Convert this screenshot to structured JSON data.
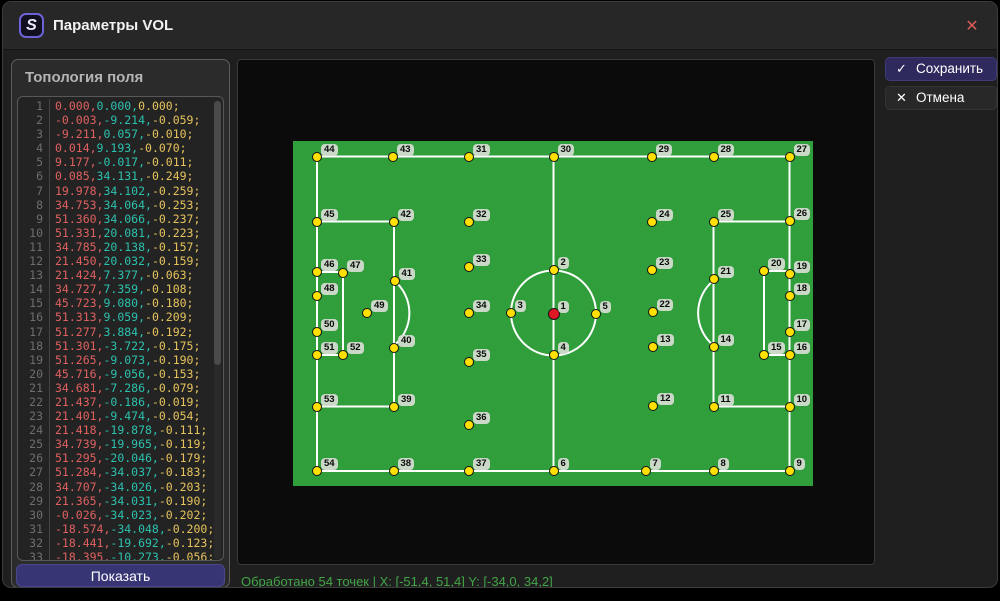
{
  "window": {
    "title": "Параметры VOL",
    "logo_letter": "S",
    "close_glyph": "✕"
  },
  "left_panel": {
    "header": "Топология поля",
    "show_button": "Показать",
    "editor": {
      "lines": [
        {
          "n": 1,
          "x": "0.000",
          "y": "0.000",
          "z": "0.000"
        },
        {
          "n": 2,
          "x": "-0.003",
          "y": "-9.214",
          "z": "-0.059"
        },
        {
          "n": 3,
          "x": "-9.211",
          "y": "0.057",
          "z": "-0.010"
        },
        {
          "n": 4,
          "x": "0.014",
          "y": "9.193",
          "z": "-0.070"
        },
        {
          "n": 5,
          "x": "9.177",
          "y": "-0.017",
          "z": "-0.011"
        },
        {
          "n": 6,
          "x": "0.085",
          "y": "34.131",
          "z": "-0.249"
        },
        {
          "n": 7,
          "x": "19.978",
          "y": "34.102",
          "z": "-0.259"
        },
        {
          "n": 8,
          "x": "34.753",
          "y": "34.064",
          "z": "-0.253"
        },
        {
          "n": 9,
          "x": "51.360",
          "y": "34.066",
          "z": "-0.237"
        },
        {
          "n": 10,
          "x": "51.331",
          "y": "20.081",
          "z": "-0.223"
        },
        {
          "n": 11,
          "x": "34.785",
          "y": "20.138",
          "z": "-0.157"
        },
        {
          "n": 12,
          "x": "21.450",
          "y": "20.032",
          "z": "-0.159"
        },
        {
          "n": 13,
          "x": "21.424",
          "y": "7.377",
          "z": "-0.063"
        },
        {
          "n": 14,
          "x": "34.727",
          "y": "7.359",
          "z": "-0.108"
        },
        {
          "n": 15,
          "x": "45.723",
          "y": "9.080",
          "z": "-0.180"
        },
        {
          "n": 16,
          "x": "51.313",
          "y": "9.059",
          "z": "-0.209"
        },
        {
          "n": 17,
          "x": "51.277",
          "y": "3.884",
          "z": "-0.192"
        },
        {
          "n": 18,
          "x": "51.301",
          "y": "-3.722",
          "z": "-0.175"
        },
        {
          "n": 19,
          "x": "51.265",
          "y": "-9.073",
          "z": "-0.190"
        },
        {
          "n": 20,
          "x": "45.716",
          "y": "-9.056",
          "z": "-0.153"
        },
        {
          "n": 21,
          "x": "34.681",
          "y": "-7.286",
          "z": "-0.079"
        },
        {
          "n": 22,
          "x": "21.437",
          "y": "-0.186",
          "z": "-0.019"
        },
        {
          "n": 23,
          "x": "21.401",
          "y": "-9.474",
          "z": "-0.054"
        },
        {
          "n": 24,
          "x": "21.418",
          "y": "-19.878",
          "z": "-0.111"
        },
        {
          "n": 25,
          "x": "34.739",
          "y": "-19.965",
          "z": "-0.119"
        },
        {
          "n": 26,
          "x": "51.295",
          "y": "-20.046",
          "z": "-0.179"
        },
        {
          "n": 27,
          "x": "51.284",
          "y": "-34.037",
          "z": "-0.183"
        },
        {
          "n": 28,
          "x": "34.707",
          "y": "-34.026",
          "z": "-0.203"
        },
        {
          "n": 29,
          "x": "21.365",
          "y": "-34.031",
          "z": "-0.190"
        },
        {
          "n": 30,
          "x": "-0.026",
          "y": "-34.023",
          "z": "-0.202"
        },
        {
          "n": 31,
          "x": "-18.574",
          "y": "-34.048",
          "z": "-0.200"
        },
        {
          "n": 32,
          "x": "-18.441",
          "y": "-19.692",
          "z": "-0.123"
        },
        {
          "n": 33,
          "x": "-18.395",
          "y": "-10.273",
          "z": "-0.056"
        }
      ]
    }
  },
  "actions": {
    "save_label": "Сохранить",
    "save_icon": "✓",
    "cancel_label": "Отмена",
    "cancel_icon": "✕"
  },
  "status_text": "Обработано 54 точек | X: [-51,4, 51,4] Y: [-34,0, 34,2]",
  "field": {
    "green": "#2f9e3b",
    "points_total": 54,
    "points": [
      {
        "n": 1,
        "x": 260.5,
        "y": 172.5,
        "red": true
      },
      {
        "n": 2,
        "x": 260.5,
        "y": 129
      },
      {
        "n": 3,
        "x": 217.5,
        "y": 172
      },
      {
        "n": 4,
        "x": 260.5,
        "y": 214
      },
      {
        "n": 5,
        "x": 302.5,
        "y": 172.5
      },
      {
        "n": 6,
        "x": 260.5,
        "y": 330
      },
      {
        "n": 7,
        "x": 352.5,
        "y": 330
      },
      {
        "n": 8,
        "x": 420.5,
        "y": 330
      },
      {
        "n": 9,
        "x": 496.5,
        "y": 330
      },
      {
        "n": 10,
        "x": 496.5,
        "y": 266
      },
      {
        "n": 11,
        "x": 420.5,
        "y": 265.5
      },
      {
        "n": 12,
        "x": 360,
        "y": 265
      },
      {
        "n": 13,
        "x": 360,
        "y": 206
      },
      {
        "n": 14,
        "x": 420.5,
        "y": 206
      },
      {
        "n": 15,
        "x": 471,
        "y": 214
      },
      {
        "n": 16,
        "x": 496.5,
        "y": 213.5
      },
      {
        "n": 17,
        "x": 496.5,
        "y": 191
      },
      {
        "n": 18,
        "x": 496.5,
        "y": 155
      },
      {
        "n": 19,
        "x": 496.5,
        "y": 132.5
      },
      {
        "n": 20,
        "x": 471,
        "y": 130
      },
      {
        "n": 21,
        "x": 420.5,
        "y": 138
      },
      {
        "n": 22,
        "x": 359.5,
        "y": 171
      },
      {
        "n": 23,
        "x": 359,
        "y": 128.5
      },
      {
        "n": 24,
        "x": 359,
        "y": 80.5
      },
      {
        "n": 25,
        "x": 420.5,
        "y": 80.5
      },
      {
        "n": 26,
        "x": 496.5,
        "y": 80
      },
      {
        "n": 27,
        "x": 496.5,
        "y": 15.5
      },
      {
        "n": 28,
        "x": 420.5,
        "y": 15.5
      },
      {
        "n": 29,
        "x": 358.5,
        "y": 15.5
      },
      {
        "n": 30,
        "x": 260.5,
        "y": 15.5
      },
      {
        "n": 31,
        "x": 176,
        "y": 15.5
      },
      {
        "n": 32,
        "x": 176,
        "y": 81
      },
      {
        "n": 33,
        "x": 176,
        "y": 126
      },
      {
        "n": 34,
        "x": 176,
        "y": 171.5
      },
      {
        "n": 35,
        "x": 176,
        "y": 220.5
      },
      {
        "n": 36,
        "x": 176,
        "y": 283.5
      },
      {
        "n": 37,
        "x": 176,
        "y": 330
      },
      {
        "n": 38,
        "x": 100.5,
        "y": 330
      },
      {
        "n": 39,
        "x": 101,
        "y": 266
      },
      {
        "n": 40,
        "x": 101,
        "y": 207
      },
      {
        "n": 41,
        "x": 101.5,
        "y": 140
      },
      {
        "n": 42,
        "x": 100.5,
        "y": 80.5
      },
      {
        "n": 43,
        "x": 100,
        "y": 16
      },
      {
        "n": 44,
        "x": 24,
        "y": 16
      },
      {
        "n": 45,
        "x": 24,
        "y": 80.5
      },
      {
        "n": 46,
        "x": 24,
        "y": 131
      },
      {
        "n": 47,
        "x": 50,
        "y": 132
      },
      {
        "n": 48,
        "x": 24,
        "y": 155
      },
      {
        "n": 49,
        "x": 74,
        "y": 171.5
      },
      {
        "n": 50,
        "x": 24,
        "y": 190.5
      },
      {
        "n": 51,
        "x": 24,
        "y": 214
      },
      {
        "n": 52,
        "x": 50,
        "y": 214
      },
      {
        "n": 53,
        "x": 24,
        "y": 265.5
      },
      {
        "n": 54,
        "x": 24,
        "y": 330
      }
    ]
  }
}
